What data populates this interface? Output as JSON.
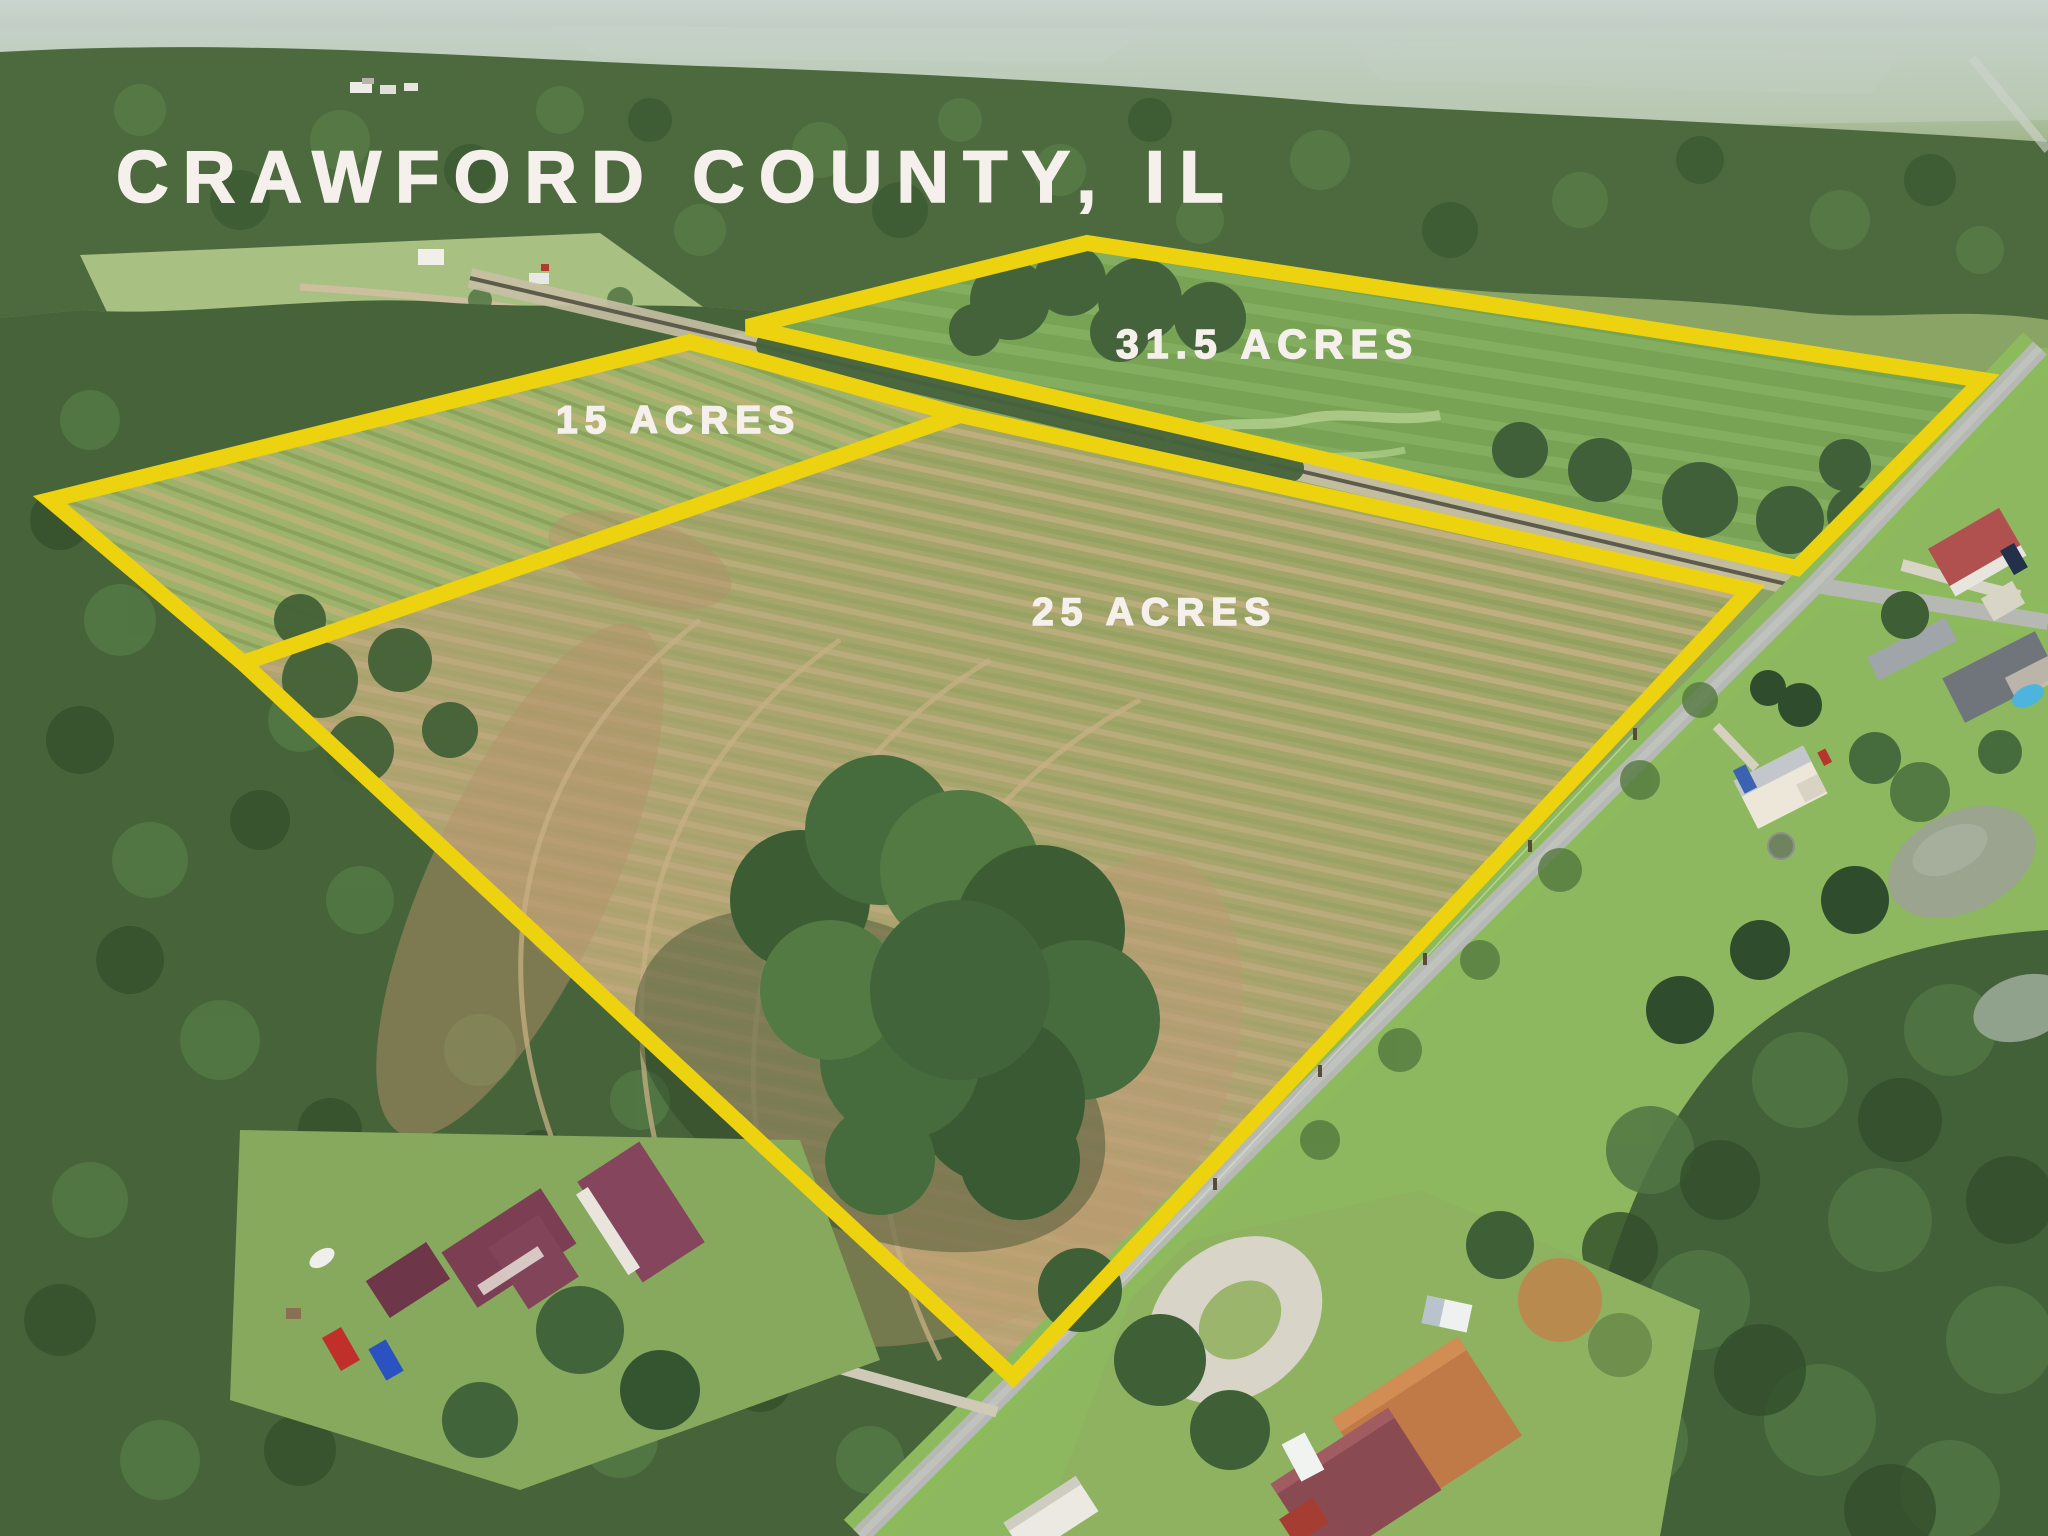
{
  "title": "CRAWFORD COUNTY, IL",
  "parcels": [
    {
      "label": "31.5 ACRES",
      "acres": "31.5"
    },
    {
      "label": "15 ACRES",
      "acres": "15"
    },
    {
      "label": "25 ACRES",
      "acres": "25"
    }
  ],
  "colors": {
    "parcel_outline": "#EDD20F",
    "label_text": "#F6F0EC"
  }
}
